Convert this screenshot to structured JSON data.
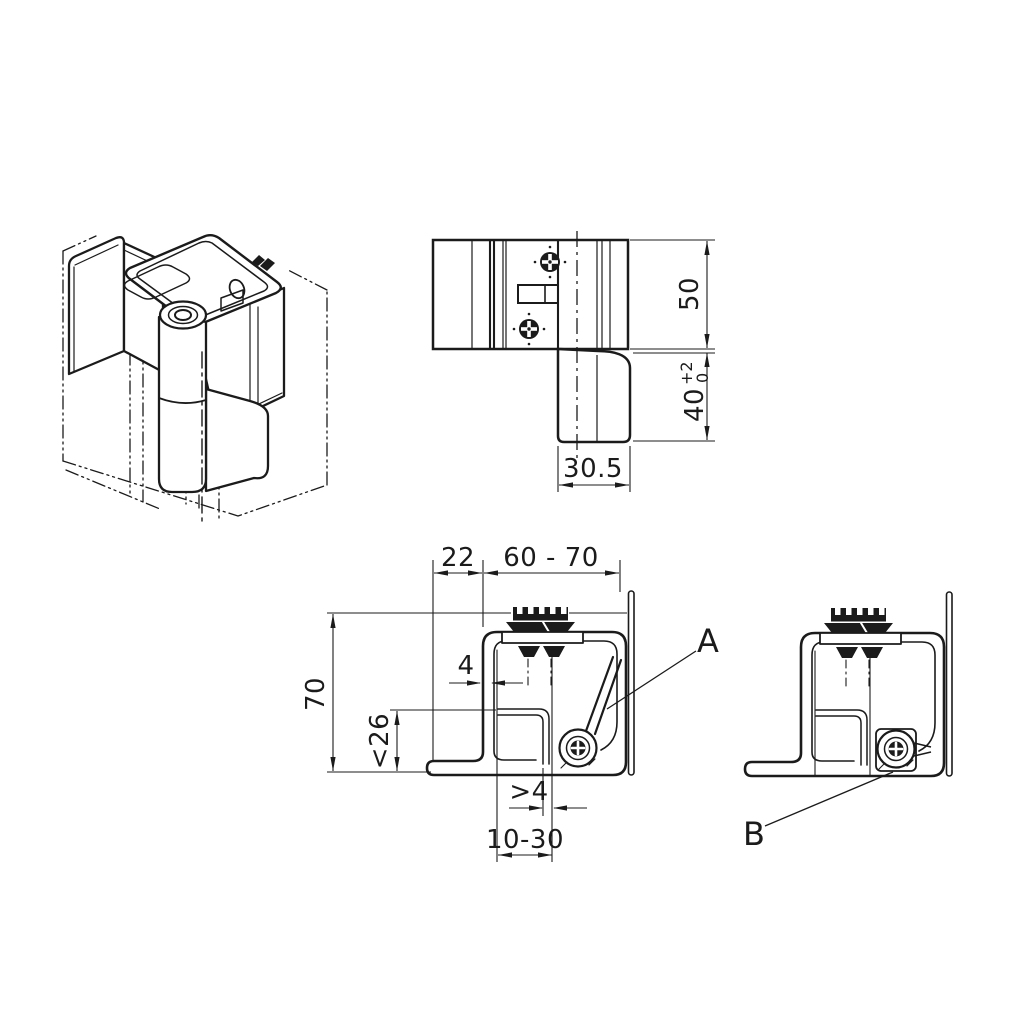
{
  "drawing": {
    "background": "#ffffff",
    "line_color": "#1b1b1b",
    "views": {
      "front": {
        "dim_height_upper": "50",
        "dim_height_lower": "40",
        "dim_height_lower_tol_plus": "+2",
        "dim_height_lower_tol_minus": "0",
        "dim_width": "30.5"
      },
      "section_main": {
        "dim_frame_offset": "22",
        "dim_clamp_range": "60 - 70",
        "dim_total_height": "70",
        "dim_inner_height": "<26",
        "dim_wall_thickness": "4",
        "dim_min_gap": ">4",
        "dim_panel_range": "10-30",
        "callout_label": "A"
      },
      "section_alt": {
        "callout_label": "B"
      }
    }
  }
}
